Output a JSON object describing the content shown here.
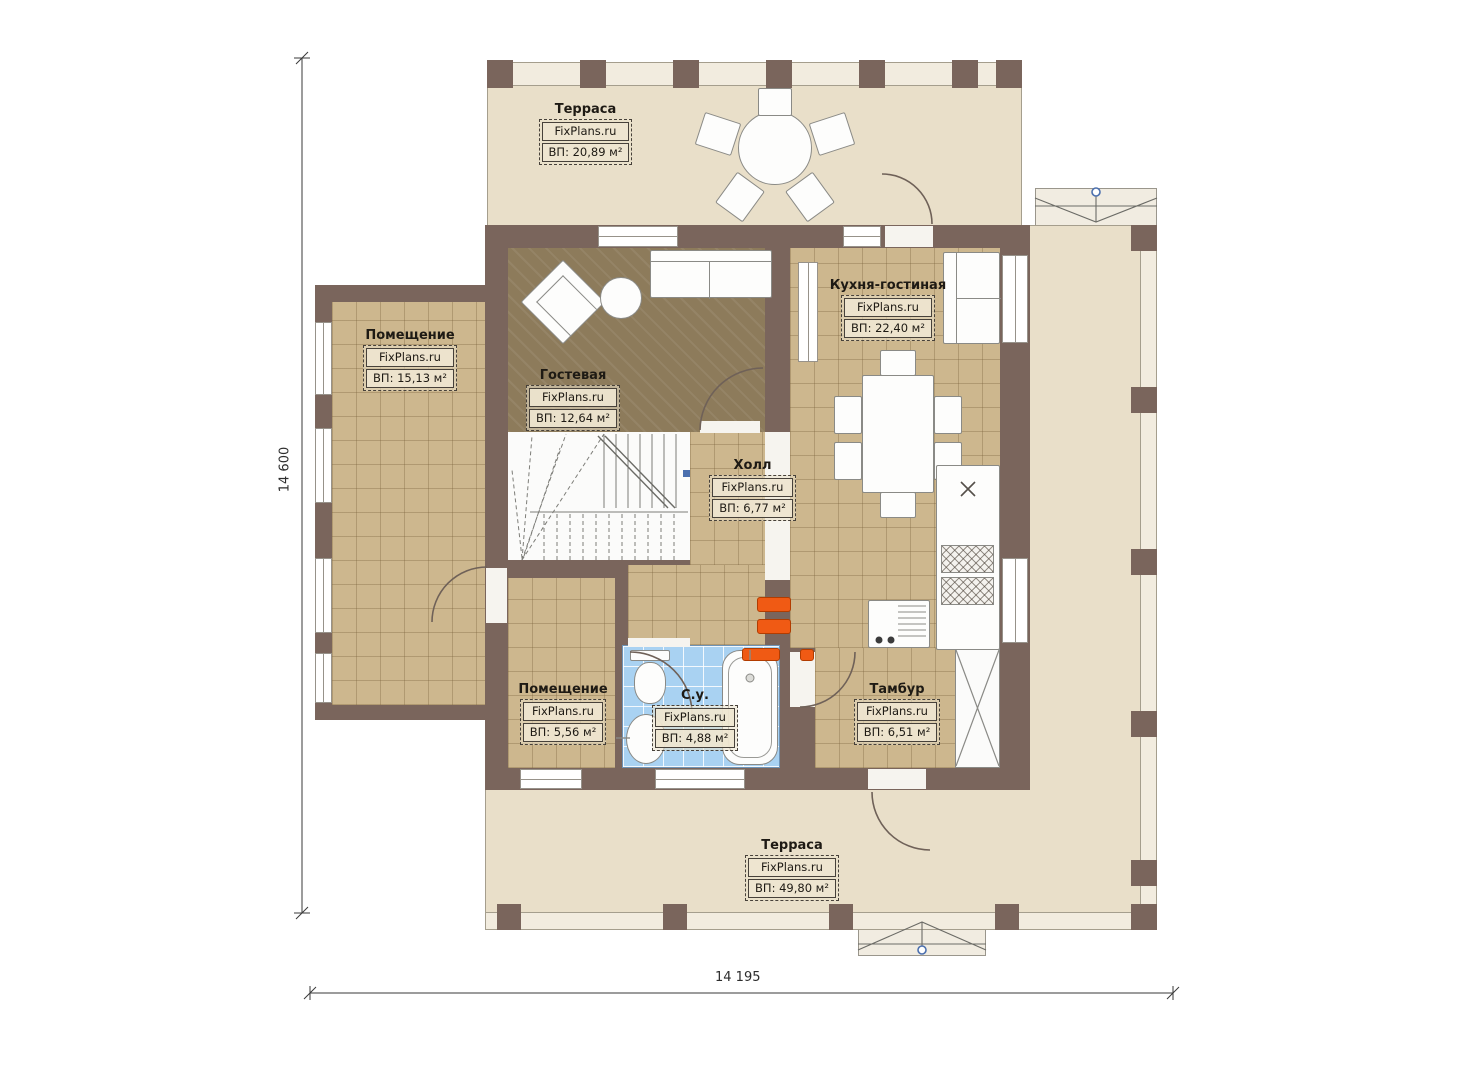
{
  "plan_title": "Floor plan level 1",
  "watermark": "FixPlans.ru",
  "dimensions": {
    "height_total": "14 600",
    "width_total": "14 195"
  },
  "rooms": [
    {
      "key": "terrace-top",
      "name": "Терраса",
      "watermark": "FixPlans.ru",
      "area": "ВП: 20,89 м²"
    },
    {
      "key": "room-left",
      "name": "Помещение",
      "watermark": "FixPlans.ru",
      "area": "ВП: 15,13 м²"
    },
    {
      "key": "guest-room",
      "name": "Гостевая",
      "watermark": "FixPlans.ru",
      "area": "ВП: 12,64 м²"
    },
    {
      "key": "kitchen-living",
      "name": "Кухня-гостиная",
      "watermark": "FixPlans.ru",
      "area": "ВП: 22,40 м²"
    },
    {
      "key": "hall",
      "name": "Холл",
      "watermark": "FixPlans.ru",
      "area": "ВП: 6,77 м²"
    },
    {
      "key": "room-small",
      "name": "Помещение",
      "watermark": "FixPlans.ru",
      "area": "ВП: 5,56 м²"
    },
    {
      "key": "bathroom",
      "name": "С.у.",
      "watermark": "FixPlans.ru",
      "area": "ВП: 4,88 м²"
    },
    {
      "key": "vestibule",
      "name": "Тамбур",
      "watermark": "FixPlans.ru",
      "area": "ВП: 6,51 м²"
    },
    {
      "key": "terrace-bottom",
      "name": "Терраса",
      "watermark": "FixPlans.ru",
      "area": "ВП: 49,80 м²"
    }
  ],
  "colors": {
    "wall": "#7a655c",
    "tile_floor": "#cdb78e",
    "guest_floor": "#8d7b5b",
    "terrace_floor": "#e9dfc9",
    "bath_floor": "#a9d2f2",
    "accent_orange": "#f05a14",
    "marker_blue": "#4b6fae"
  }
}
